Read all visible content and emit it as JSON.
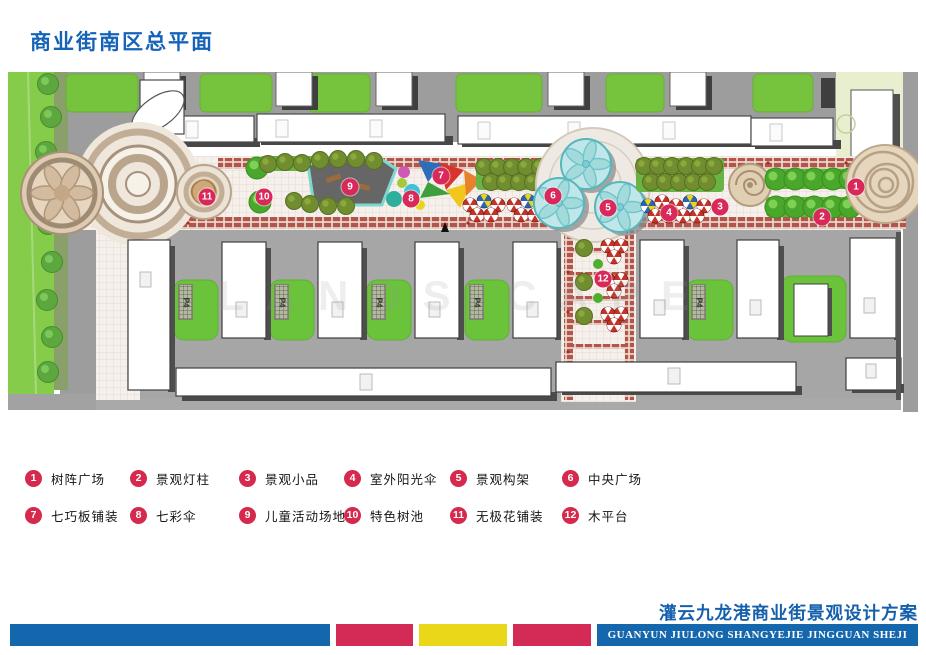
{
  "page": {
    "title": "商业街南区总平面"
  },
  "plan": {
    "watermark": "LANDS CAPE",
    "p4_label": "P4",
    "markers": [
      {
        "num": "1",
        "x": 848,
        "y": 115
      },
      {
        "num": "2",
        "x": 814,
        "y": 145
      },
      {
        "num": "3",
        "x": 712,
        "y": 135
      },
      {
        "num": "4",
        "x": 661,
        "y": 141
      },
      {
        "num": "5",
        "x": 600,
        "y": 136
      },
      {
        "num": "6",
        "x": 545,
        "y": 124
      },
      {
        "num": "7",
        "x": 433,
        "y": 104
      },
      {
        "num": "8",
        "x": 403,
        "y": 127
      },
      {
        "num": "9",
        "x": 342,
        "y": 115
      },
      {
        "num": "10",
        "x": 256,
        "y": 125
      },
      {
        "num": "11",
        "x": 199,
        "y": 125
      },
      {
        "num": "12",
        "x": 595,
        "y": 207
      }
    ]
  },
  "legend": {
    "items": [
      {
        "num": "1",
        "label": "树阵广场"
      },
      {
        "num": "2",
        "label": "景观灯柱"
      },
      {
        "num": "3",
        "label": "景观小品"
      },
      {
        "num": "4",
        "label": "室外阳光伞"
      },
      {
        "num": "5",
        "label": "景观构架"
      },
      {
        "num": "6",
        "label": "中央广场"
      },
      {
        "num": "7",
        "label": "七巧板铺装"
      },
      {
        "num": "8",
        "label": "七彩伞"
      },
      {
        "num": "9",
        "label": "儿童活动场地"
      },
      {
        "num": "10",
        "label": "特色树池"
      },
      {
        "num": "11",
        "label": "无极花铺装"
      },
      {
        "num": "12",
        "label": "木平台"
      }
    ]
  },
  "footer": {
    "title_cn": "灌云九龙港商业街景观设计方案",
    "title_en": "GUANYUN JIULONG SHANGYEJIE JINGGUAN SHEJI FANGAN"
  },
  "colors": {
    "accent_blue": "#1466ad",
    "accent_red": "#d42a56",
    "accent_yellow": "#ead71a",
    "marker_red": "#d8295a"
  }
}
